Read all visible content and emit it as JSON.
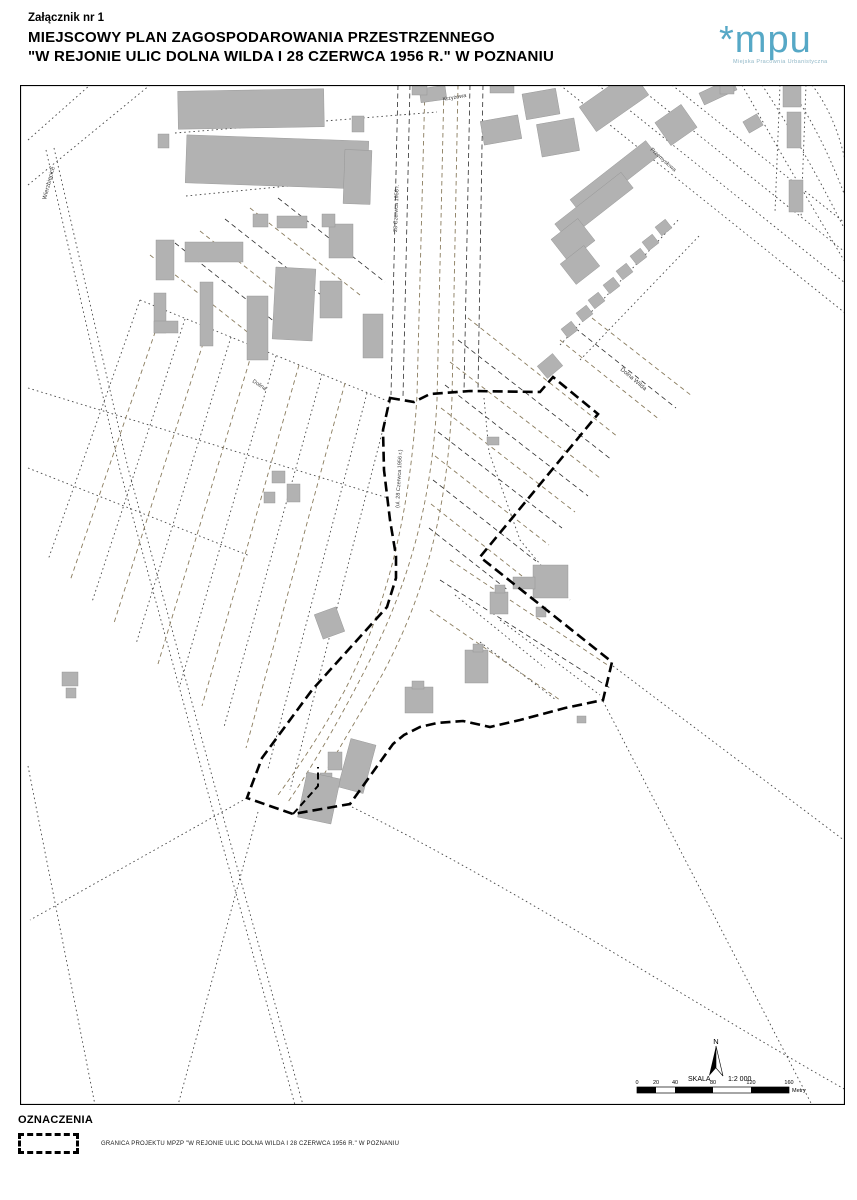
{
  "header": {
    "attachment": "Załącznik nr 1",
    "title_line1": "MIEJSCOWY PLAN ZAGOSPODAROWANIA PRZESTRZENNEGO",
    "title_line2": "\"W REJONIE ULIC DOLNA WILDA I 28 CZERWCA 1956 R.\" W POZNANIU"
  },
  "logo": {
    "mark": "*mpu",
    "subtitle": "Miejska Pracownia Urbanistyczna",
    "color": "#56a8c6",
    "sub_color": "#8fb6c6"
  },
  "legend": {
    "heading": "OZNACZENIA",
    "items": [
      {
        "symbol": "dashed-boundary",
        "label": "GRANICA PROJEKTU MPZP \"W REJONIE ULIC DOLNA WILDA I 28 CZERWCA 1956 R.\" W POZNANIU"
      }
    ]
  },
  "map": {
    "north_label": "N",
    "scale": {
      "label": "SKALA",
      "ratio": "1:2 000",
      "unit": "Metry",
      "ticks": [
        {
          "label": "0",
          "x": 637
        },
        {
          "label": "20",
          "x": 656
        },
        {
          "label": "40",
          "x": 675
        },
        {
          "label": "80",
          "x": 713
        },
        {
          "label": "120",
          "x": 751
        },
        {
          "label": "160",
          "x": 789
        }
      ],
      "bar": {
        "y": 1087,
        "h": 6,
        "segments": [
          [
            637,
            656,
            "#000"
          ],
          [
            656,
            675,
            "#fff"
          ],
          [
            675,
            713,
            "#000"
          ],
          [
            713,
            751,
            "#fff"
          ],
          [
            751,
            789,
            "#000"
          ]
        ]
      }
    },
    "street_labels": [
      {
        "text": "Wierzbięcice",
        "x": 46,
        "y": 200,
        "rot": -75,
        "fs": 6
      },
      {
        "text": "28 Czerwca 1956 r.",
        "x": 397,
        "y": 232,
        "rot": -88,
        "fs": 5.5
      },
      {
        "text": "(ul. 28 Czerwca 1956 r.)",
        "x": 399,
        "y": 508,
        "rot": -87,
        "fs": 5.5
      },
      {
        "text": "Dolna Wilda",
        "x": 620,
        "y": 370,
        "rot": 40,
        "fs": 6
      },
      {
        "text": "Przemysłowa",
        "x": 650,
        "y": 150,
        "rot": 42,
        "fs": 5.5
      },
      {
        "text": "Krzyżowa",
        "x": 443,
        "y": 101,
        "rot": -10,
        "fs": 5.5
      },
      {
        "text": "Dolina",
        "x": 252,
        "y": 382,
        "rot": 33,
        "fs": 5.5
      }
    ],
    "boundary": {
      "d": "M390,398 L414,402 L430,394 L470,391 L540,392 L553,377 L598,414 L480,557 L612,662 L603,700 L565,708 L520,720 L490,727 L463,721 L437,723 L420,727 L404,735 L393,744 L350,804 L293,814 L247,798 L251,787 L262,758 L312,690 L387,607 L396,578 L396,556 L390,520 L384,470 L383,430 Z",
      "notch": "M293,814 L318,786 L318,767"
    },
    "buildings": [
      [
        178,
        90,
        146,
        38,
        -1
      ],
      [
        186,
        138,
        182,
        48,
        2
      ],
      [
        344,
        150,
        27,
        54,
        2
      ],
      [
        158,
        134,
        11,
        14,
        0
      ],
      [
        156,
        240,
        18,
        40,
        0
      ],
      [
        185,
        242,
        58,
        20,
        0
      ],
      [
        200,
        282,
        13,
        64,
        0
      ],
      [
        154,
        293,
        12,
        40,
        0
      ],
      [
        154,
        321,
        24,
        12,
        0
      ],
      [
        247,
        296,
        21,
        64,
        0
      ],
      [
        274,
        268,
        40,
        72,
        3
      ],
      [
        320,
        281,
        22,
        37,
        0
      ],
      [
        329,
        224,
        24,
        34,
        0
      ],
      [
        352,
        116,
        12,
        16,
        0
      ],
      [
        253,
        214,
        15,
        13,
        0
      ],
      [
        277,
        216,
        30,
        12,
        0
      ],
      [
        322,
        214,
        13,
        13,
        0
      ],
      [
        363,
        314,
        20,
        44,
        0
      ],
      [
        272,
        471,
        13,
        12,
        0
      ],
      [
        287,
        484,
        13,
        18,
        0
      ],
      [
        264,
        492,
        11,
        11,
        0
      ],
      [
        62,
        672,
        16,
        14,
        0
      ],
      [
        66,
        688,
        10,
        10,
        0
      ],
      [
        420,
        87,
        26,
        14,
        -8
      ],
      [
        482,
        118,
        38,
        24,
        -10
      ],
      [
        524,
        91,
        34,
        26,
        -10
      ],
      [
        539,
        121,
        38,
        33,
        -10
      ],
      [
        490,
        85,
        24,
        8,
        0
      ],
      [
        582,
        86,
        64,
        30,
        -35
      ],
      [
        660,
        111,
        32,
        28,
        -35
      ],
      [
        700,
        85,
        36,
        13,
        -25
      ],
      [
        566,
        168,
        96,
        20,
        -38
      ],
      [
        552,
        196,
        84,
        20,
        -38
      ],
      [
        556,
        226,
        34,
        28,
        -38
      ],
      [
        565,
        252,
        30,
        26,
        -38
      ],
      [
        563,
        324,
        13,
        11,
        -38
      ],
      [
        578,
        308,
        13,
        11,
        -38
      ],
      [
        590,
        295,
        13,
        11,
        -38
      ],
      [
        605,
        280,
        13,
        11,
        -38
      ],
      [
        618,
        266,
        13,
        11,
        -38
      ],
      [
        632,
        251,
        13,
        11,
        -38
      ],
      [
        644,
        237,
        13,
        11,
        -38
      ],
      [
        657,
        222,
        13,
        11,
        -38
      ],
      [
        783,
        85,
        18,
        22,
        0
      ],
      [
        787,
        112,
        14,
        36,
        0
      ],
      [
        789,
        180,
        14,
        32,
        0
      ],
      [
        745,
        117,
        16,
        13,
        -30
      ],
      [
        720,
        85,
        14,
        9,
        0
      ],
      [
        540,
        358,
        20,
        16,
        -40
      ],
      [
        487,
        437,
        12,
        8,
        0
      ],
      [
        533,
        565,
        35,
        33,
        0
      ],
      [
        513,
        577,
        22,
        12,
        0
      ],
      [
        536,
        607,
        10,
        10,
        0
      ],
      [
        465,
        650,
        23,
        33,
        0
      ],
      [
        473,
        644,
        10,
        8,
        0
      ],
      [
        405,
        687,
        28,
        26,
        0
      ],
      [
        412,
        681,
        12,
        8,
        0
      ],
      [
        318,
        610,
        23,
        26,
        -20
      ],
      [
        344,
        741,
        26,
        50,
        15
      ],
      [
        328,
        752,
        14,
        18,
        0
      ],
      [
        320,
        773,
        12,
        18,
        0
      ],
      [
        302,
        775,
        34,
        46,
        12
      ],
      [
        577,
        716,
        9,
        7,
        0
      ],
      [
        490,
        592,
        18,
        22,
        0
      ],
      [
        495,
        585,
        10,
        8,
        0
      ],
      [
        412,
        85,
        15,
        10,
        0
      ]
    ],
    "lines": [
      {
        "d": "M46,150 L120,470 L210,800 L295,1105",
        "s": "dot"
      },
      {
        "d": "M54,148 L128,468 L218,798 L303,1105",
        "s": "dot"
      },
      {
        "d": "M28,140 L90,85",
        "s": "dot"
      },
      {
        "d": "M28,185 L150,85",
        "s": "dot"
      },
      {
        "d": "M28,388 L388,498",
        "s": "dot"
      },
      {
        "d": "M28,468 L250,556",
        "s": "dot"
      },
      {
        "d": "M140,300 L390,402",
        "s": "dot"
      },
      {
        "d": "M175,133 L437,112",
        "s": "dot"
      },
      {
        "d": "M186,196 L370,178",
        "s": "dot"
      },
      {
        "d": "M247,798 L30,920",
        "s": "dot"
      },
      {
        "d": "M258,812 L178,1105",
        "s": "dot"
      },
      {
        "d": "M28,766 L95,1105",
        "s": "dot"
      },
      {
        "d": "M352,807 C520,890 720,1020 855,1095",
        "s": "dot"
      },
      {
        "d": "M613,666 L857,850",
        "s": "dot"
      },
      {
        "d": "M603,701 L812,1105",
        "s": "dot"
      },
      {
        "d": "M560,85 L845,313",
        "s": "dot"
      },
      {
        "d": "M598,85 L845,283",
        "s": "dot"
      },
      {
        "d": "M636,85 L845,252",
        "s": "dot"
      },
      {
        "d": "M672,85 L845,223",
        "s": "dot"
      },
      {
        "d": "M560,345 L680,218",
        "s": "dot"
      },
      {
        "d": "M580,360 L700,235",
        "s": "dot"
      },
      {
        "d": "M742,85 Q790,170 845,262",
        "s": "dot"
      },
      {
        "d": "M762,85 Q805,150 845,230",
        "s": "dot"
      },
      {
        "d": "M788,85 Q820,130 845,196",
        "s": "dot"
      },
      {
        "d": "M812,85 Q835,115 845,160",
        "s": "dot"
      },
      {
        "d": "M780,85 L775,212",
        "s": "dot"
      },
      {
        "d": "M806,85 L801,218",
        "s": "dot"
      },
      {
        "d": "M484,398 L489,452 L520,540 L570,600",
        "s": "dot"
      },
      {
        "d": "M500,620 L600,695",
        "s": "dot"
      },
      {
        "d": "M480,642 L556,700",
        "s": "dot"
      },
      {
        "d": "M455,595 L545,668",
        "s": "dot"
      },
      {
        "d": "M140,300 L48,560",
        "s": "dot"
      },
      {
        "d": "M163,309 L70,581",
        "s": "olv"
      },
      {
        "d": "M185,319 L92,602",
        "s": "dot"
      },
      {
        "d": "M208,328 L114,623",
        "s": "olv"
      },
      {
        "d": "M231,337 L136,644",
        "s": "dot"
      },
      {
        "d": "M254,346 L158,664",
        "s": "olv"
      },
      {
        "d": "M276,356 L180,685",
        "s": "dot"
      },
      {
        "d": "M299,365 L202,706",
        "s": "olv"
      },
      {
        "d": "M322,374 L224,727",
        "s": "dot"
      },
      {
        "d": "M345,383 L246,748",
        "s": "olv"
      },
      {
        "d": "M367,393 L268,769",
        "s": "dot"
      },
      {
        "d": "M390,402 L290,790",
        "s": "dot"
      },
      {
        "d": "M398,85 L391,395",
        "s": "dsh"
      },
      {
        "d": "M410,85 L403,397",
        "s": "dsh"
      },
      {
        "d": "M470,85 L464,392",
        "s": "dsh"
      },
      {
        "d": "M483,85 L478,390",
        "s": "dsh"
      },
      {
        "d": "M425,85 L417,395 C410,520 385,610 345,690 C320,735 300,765 278,795",
        "s": "olv"
      },
      {
        "d": "M444,85 L437,400 C432,500 410,580 370,660 C340,720 310,770 288,802",
        "s": "olv"
      },
      {
        "d": "M458,85 L452,398 C448,510 425,595 382,675 C352,728 325,772 302,812",
        "s": "olv"
      },
      {
        "d": "M468,318 L618,437",
        "s": "olv"
      },
      {
        "d": "M458,340 L612,460",
        "s": "dsh"
      },
      {
        "d": "M450,362 L600,478",
        "s": "olv"
      },
      {
        "d": "M445,385 L588,496",
        "s": "dsh"
      },
      {
        "d": "M441,408 L575,512",
        "s": "olv"
      },
      {
        "d": "M438,432 L562,528",
        "s": "dsh"
      },
      {
        "d": "M435,456 L549,545",
        "s": "olv"
      },
      {
        "d": "M433,480 L536,561",
        "s": "dsh"
      },
      {
        "d": "M431,504 L522,576",
        "s": "olv"
      },
      {
        "d": "M429,528 L509,591",
        "s": "dsh"
      },
      {
        "d": "M450,560 L612,668",
        "s": "olv"
      },
      {
        "d": "M440,580 L610,688",
        "s": "dsh"
      },
      {
        "d": "M430,610 L560,700",
        "s": "olv"
      },
      {
        "d": "M560,340 L660,420",
        "s": "olv"
      },
      {
        "d": "M575,328 L676,408",
        "s": "dsh"
      },
      {
        "d": "M592,318 L692,396",
        "s": "olv"
      },
      {
        "d": "M150,255 L260,342",
        "s": "olv"
      },
      {
        "d": "M175,243 L285,330",
        "s": "dsh"
      },
      {
        "d": "M200,231 L310,318",
        "s": "olv"
      },
      {
        "d": "M225,219 L335,306",
        "s": "dsh"
      },
      {
        "d": "M250,208 L360,295",
        "s": "olv"
      },
      {
        "d": "M278,198 L385,282",
        "s": "dsh"
      },
      {
        "d": "M622,87 L640,93",
        "s": "red"
      }
    ]
  }
}
